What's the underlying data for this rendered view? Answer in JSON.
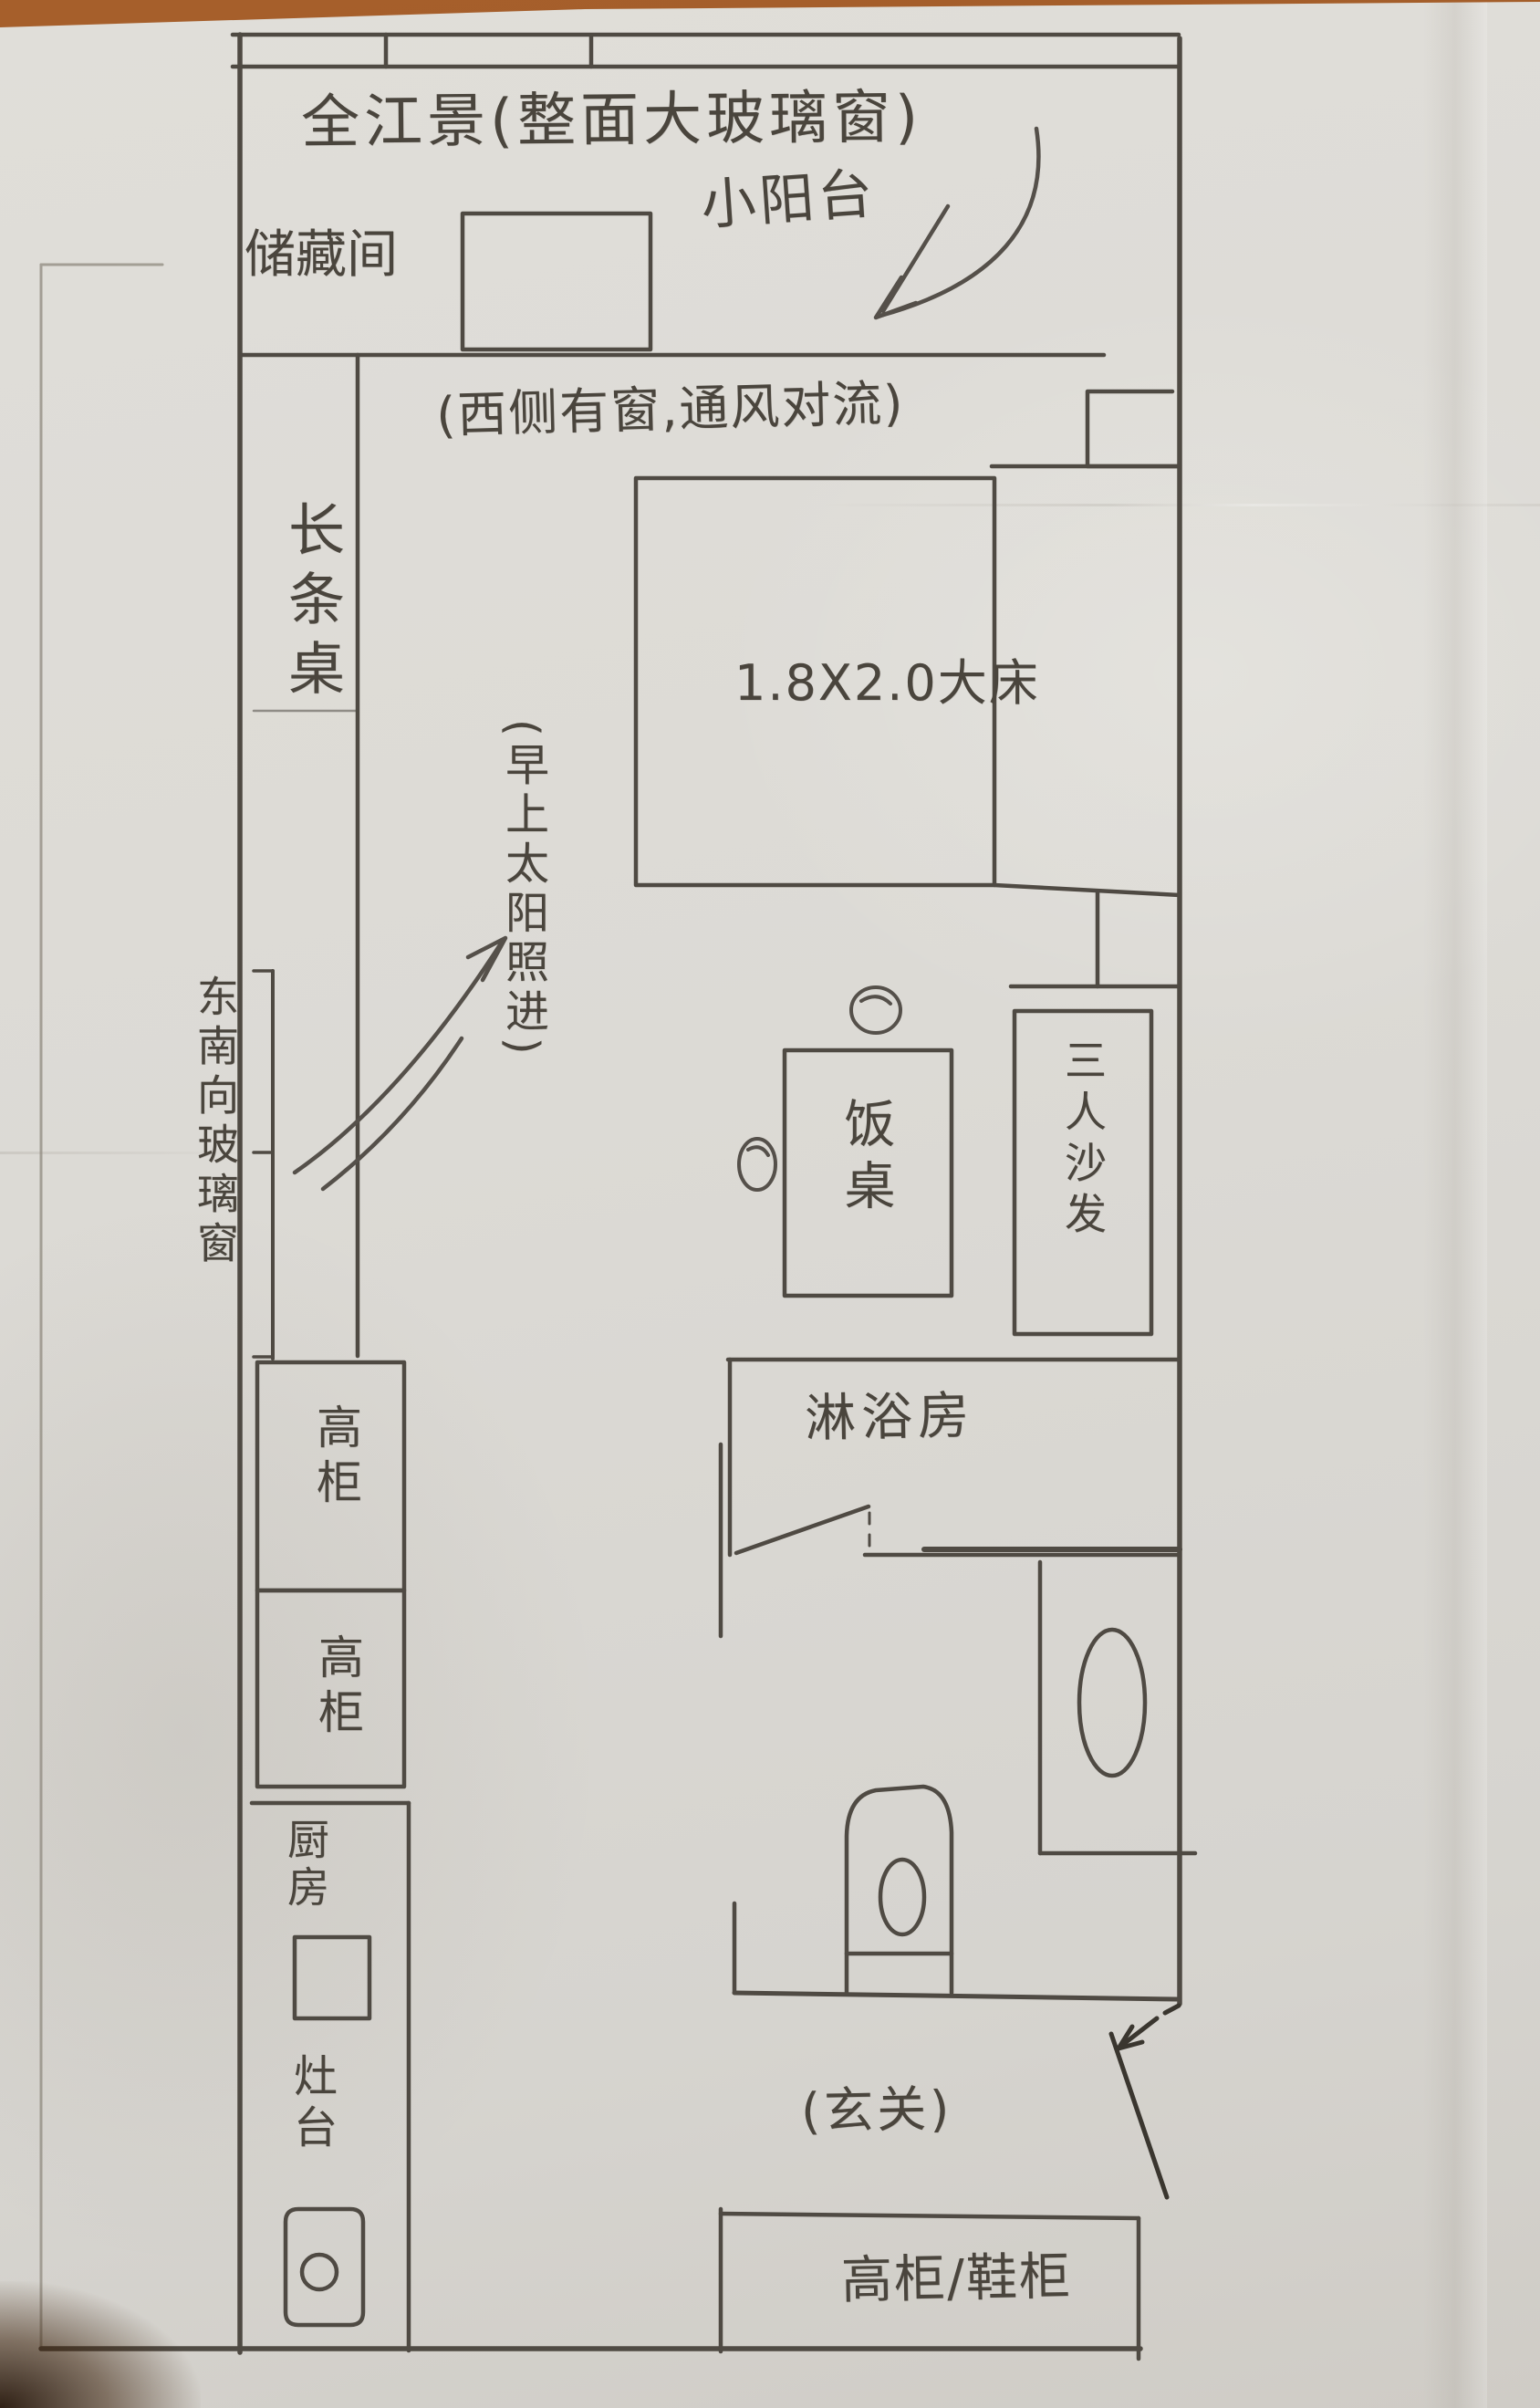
{
  "meta": {
    "kind": "hand-drawn apartment floor plan on paper",
    "language": "zh-CN"
  },
  "palette": {
    "table_surface": "#9a5827",
    "paper": "#dcdad5",
    "pencil": "#4f4a43",
    "pencil_dark": "#3a362f",
    "pencil_faint": "#8f897f"
  },
  "labels": {
    "river_view_window": "全江景(整面大玻璃窗)",
    "storage_room": "储藏间",
    "small_balcony": "小阳台",
    "west_window_note": "(西侧有窗,通风对流)",
    "bed": "1.8X2.0大床",
    "long_table": "长条桌",
    "morning_sun_note": "(早上太阳照进)",
    "southeast_glass_window": "东南向玻璃窗",
    "dining_table": "饭桌",
    "sofa": "三人沙发",
    "shower_room": "淋浴房",
    "tall_cabinet_1": "高柜",
    "tall_cabinet_2": "高柜",
    "kitchen": "厨房",
    "stove": "灶台",
    "entry": "(玄关)",
    "entry_cabinet": "高柜/鞋柜"
  }
}
